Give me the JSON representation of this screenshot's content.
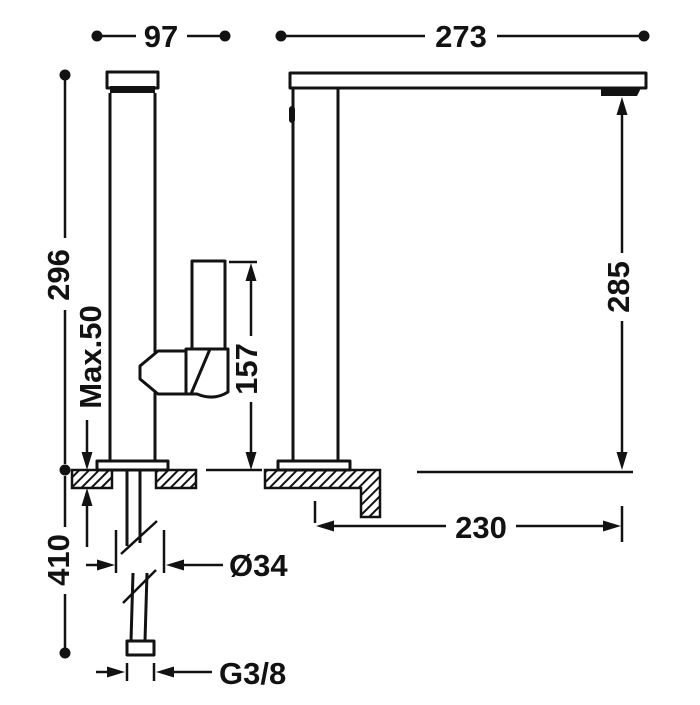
{
  "colors": {
    "line": "#121212",
    "background": "#ffffff"
  },
  "dimensions": {
    "front_width": "97",
    "overall_depth": "273",
    "body_height": "296",
    "max_deck_thickness": "Max.50",
    "handle_top_height": "157",
    "spout_outlet_height": "285",
    "spout_reach": "230",
    "hose_length": "410",
    "shank_diameter": "Ø34",
    "connection_thread": "G3/8"
  }
}
